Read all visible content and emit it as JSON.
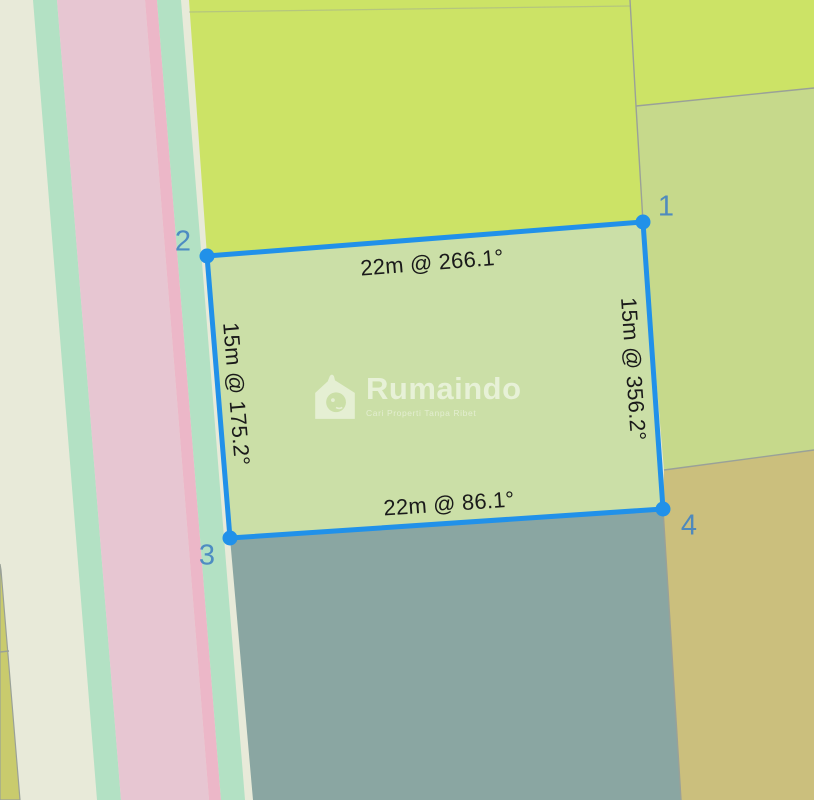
{
  "brand": {
    "watermark_text": "Rumaindo",
    "watermark_tagline": "Cari Properti Tanpa Ribet"
  },
  "map": {
    "description": "land-parcel measurement map view",
    "colors": {
      "pale_strip": "#e8ead9",
      "mint_strip": "#b3e1c4",
      "pink_road": "#e7c6d2",
      "pink_stripe": "#ecb7c8",
      "bright_green": "#cce366",
      "olive_green": "#c6d98b",
      "tan_field": "#cbbf7d",
      "dark_teal": "#8aa6a2",
      "olive_yellow": "#c9cb6d",
      "boundary_line": "#9aa198",
      "parcel_fill": "#cbdfa7",
      "parcel_stroke": "#2191e9",
      "corner_label": "#4585c2",
      "label_text": "#1a1a1a",
      "watermark_white": "rgba(255,255,255,0.55)"
    }
  },
  "parcel": {
    "corners": [
      {
        "id": "1"
      },
      {
        "id": "2"
      },
      {
        "id": "3"
      },
      {
        "id": "4"
      }
    ],
    "sides": {
      "top": {
        "label": "22m @ 266.1°",
        "length_m": 22,
        "bearing_deg": 266.1
      },
      "right": {
        "label": "15m @ 356.2°",
        "length_m": 15,
        "bearing_deg": 356.2
      },
      "bottom": {
        "label": "22m @ 86.1°",
        "length_m": 22,
        "bearing_deg": 86.1
      },
      "left": {
        "label": "15m @ 175.2°",
        "length_m": 15,
        "bearing_deg": 175.2
      }
    }
  }
}
